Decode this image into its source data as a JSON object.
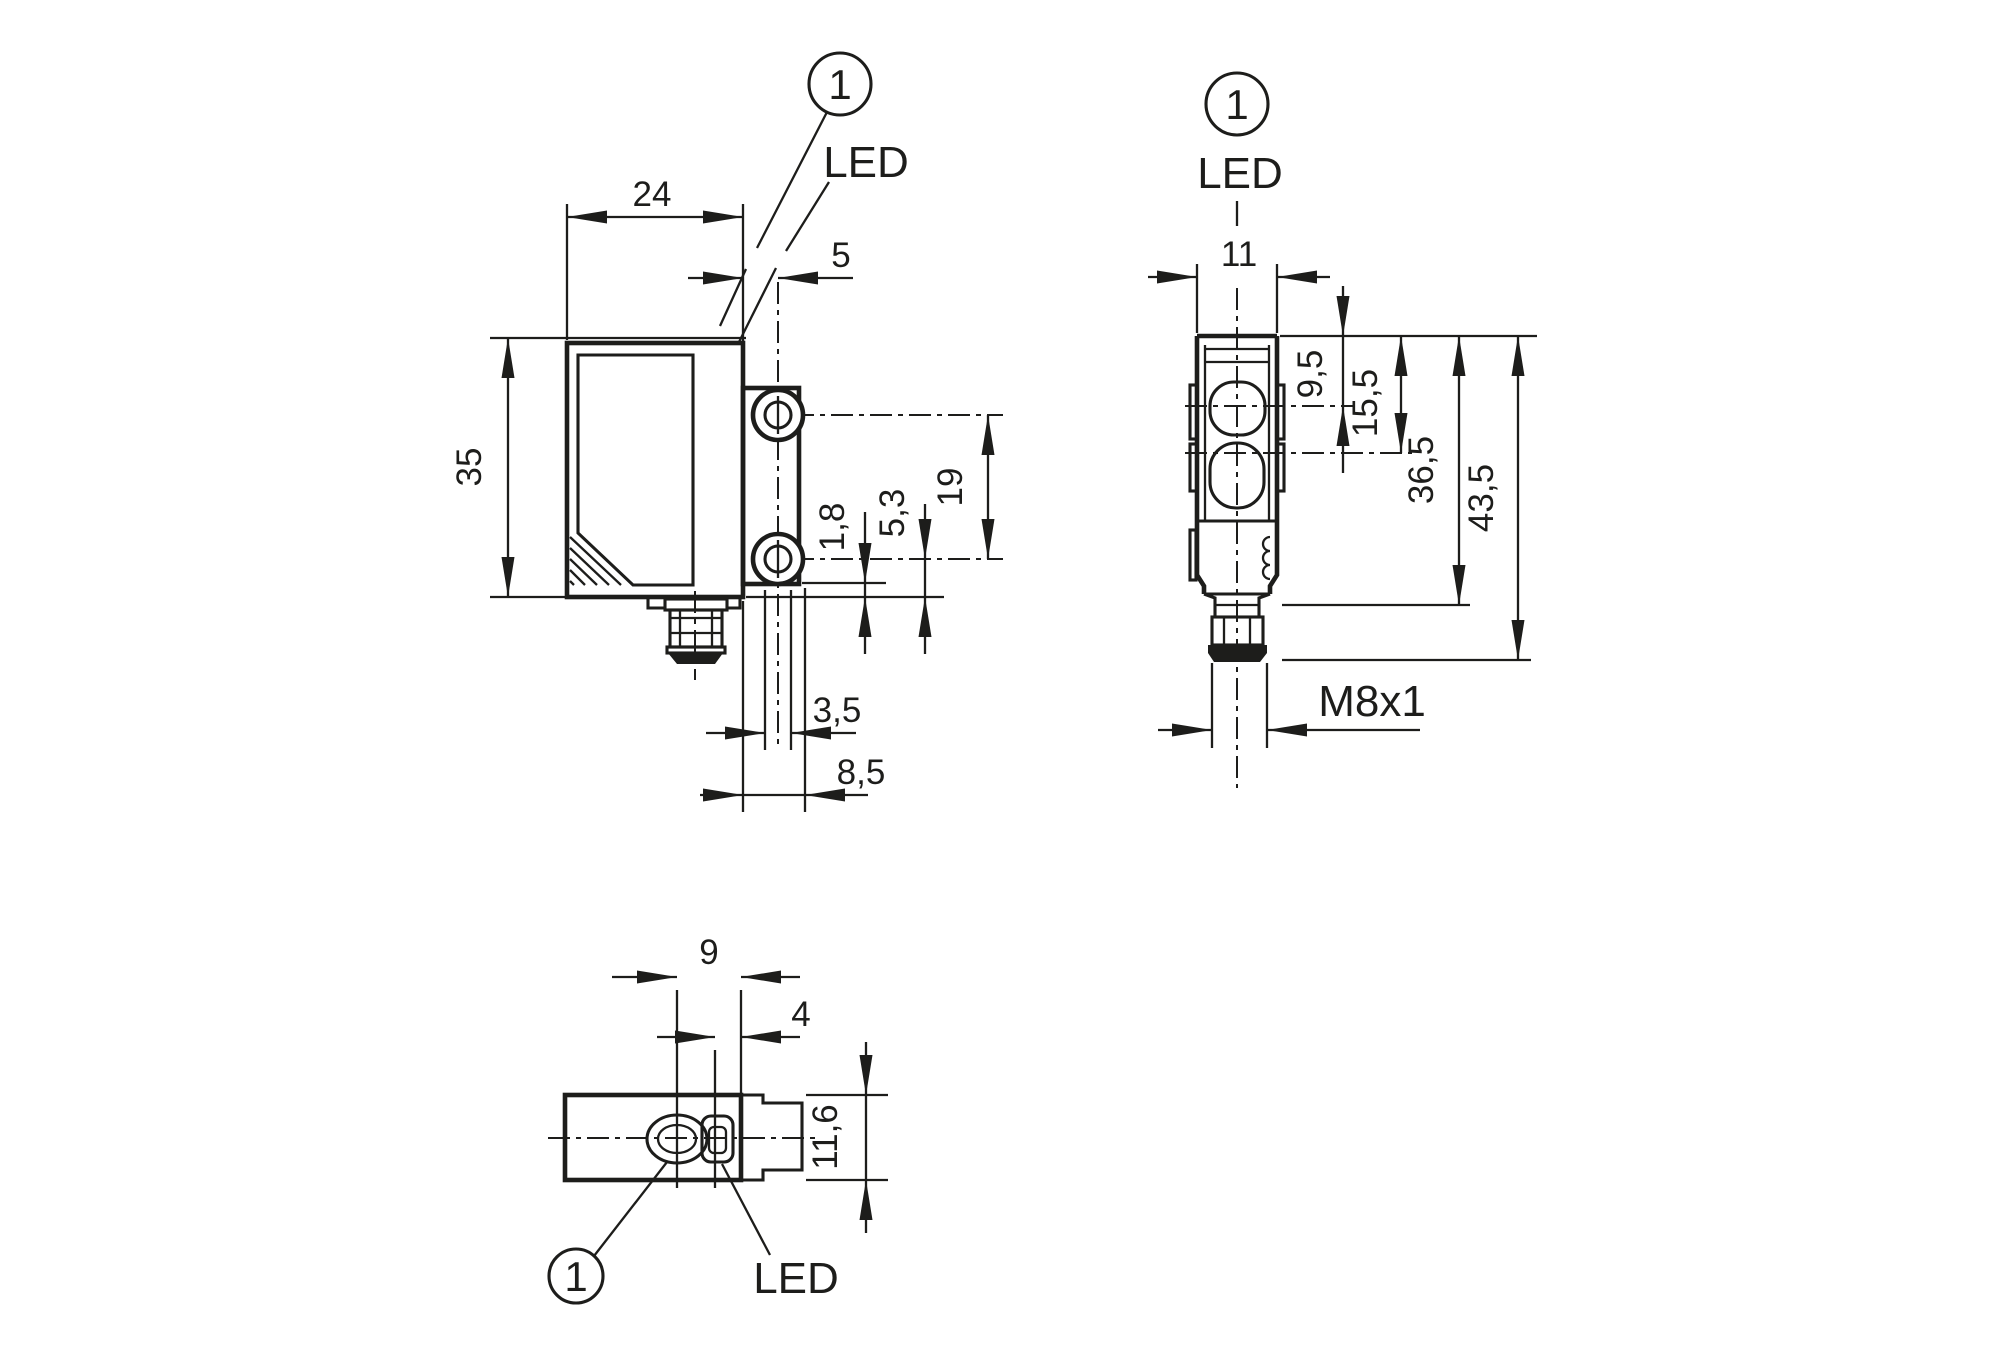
{
  "drawing": {
    "type": "technical-dimension-drawing",
    "units_style": "mm (decimal comma)",
    "colors": {
      "line": "#1d1d1b",
      "background": "#ffffff"
    },
    "side_view": {
      "dim_width": "24",
      "dim_face_to_holes": "5",
      "dim_height": "35",
      "dim_bracket_to_bottom": "1,8",
      "dim_hole_to_bottom": "5,3",
      "dim_hole_spacing": "19",
      "dim_hole_width": "3,5",
      "dim_bracket_width": "8,5",
      "callout": "1",
      "led_label": "LED"
    },
    "front_view": {
      "dim_width": "11",
      "dim_receiver_axis": "9,5",
      "dim_emitter_axis": "15,5",
      "dim_body_length": "36,5",
      "dim_total_length": "43,5",
      "thread_label": "M8x1",
      "callout": "1",
      "led_label": "LED"
    },
    "bottom_view": {
      "dim_lens_to_face": "9",
      "dim_led_to_face": "4",
      "dim_height": "11,6",
      "callout": "1",
      "led_label": "LED"
    }
  }
}
